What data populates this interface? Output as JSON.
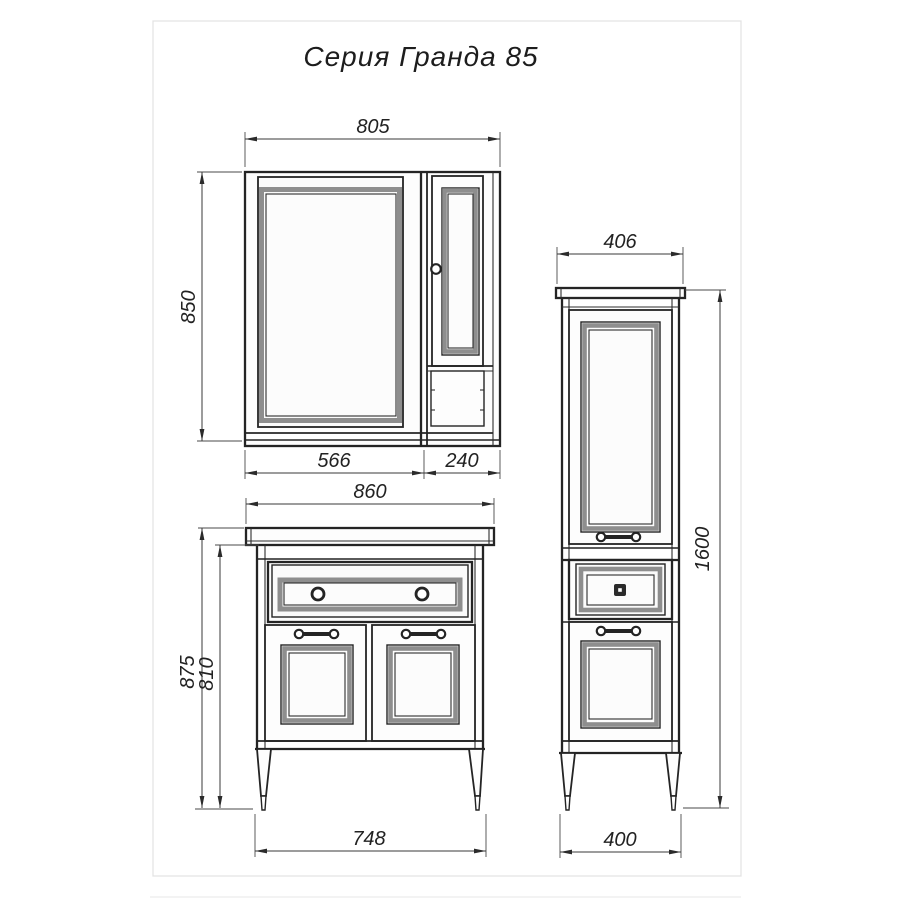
{
  "title": "Серия Гранда 85",
  "dimensions": {
    "mirror_cabinet": {
      "width": "805",
      "height": "850",
      "mirror_section_width": "566",
      "side_cabinet_width": "240"
    },
    "vanity": {
      "width": "860",
      "total_height": "875",
      "body_height": "810",
      "feet_width": "748"
    },
    "tall_cabinet": {
      "width": "406",
      "height": "1600",
      "feet_width": "400"
    }
  },
  "colors": {
    "line": "#242424",
    "dimension_line": "#3a3a3a",
    "bevel_gray": "#8e8e8e",
    "page_frame": "#e2e2e2"
  }
}
